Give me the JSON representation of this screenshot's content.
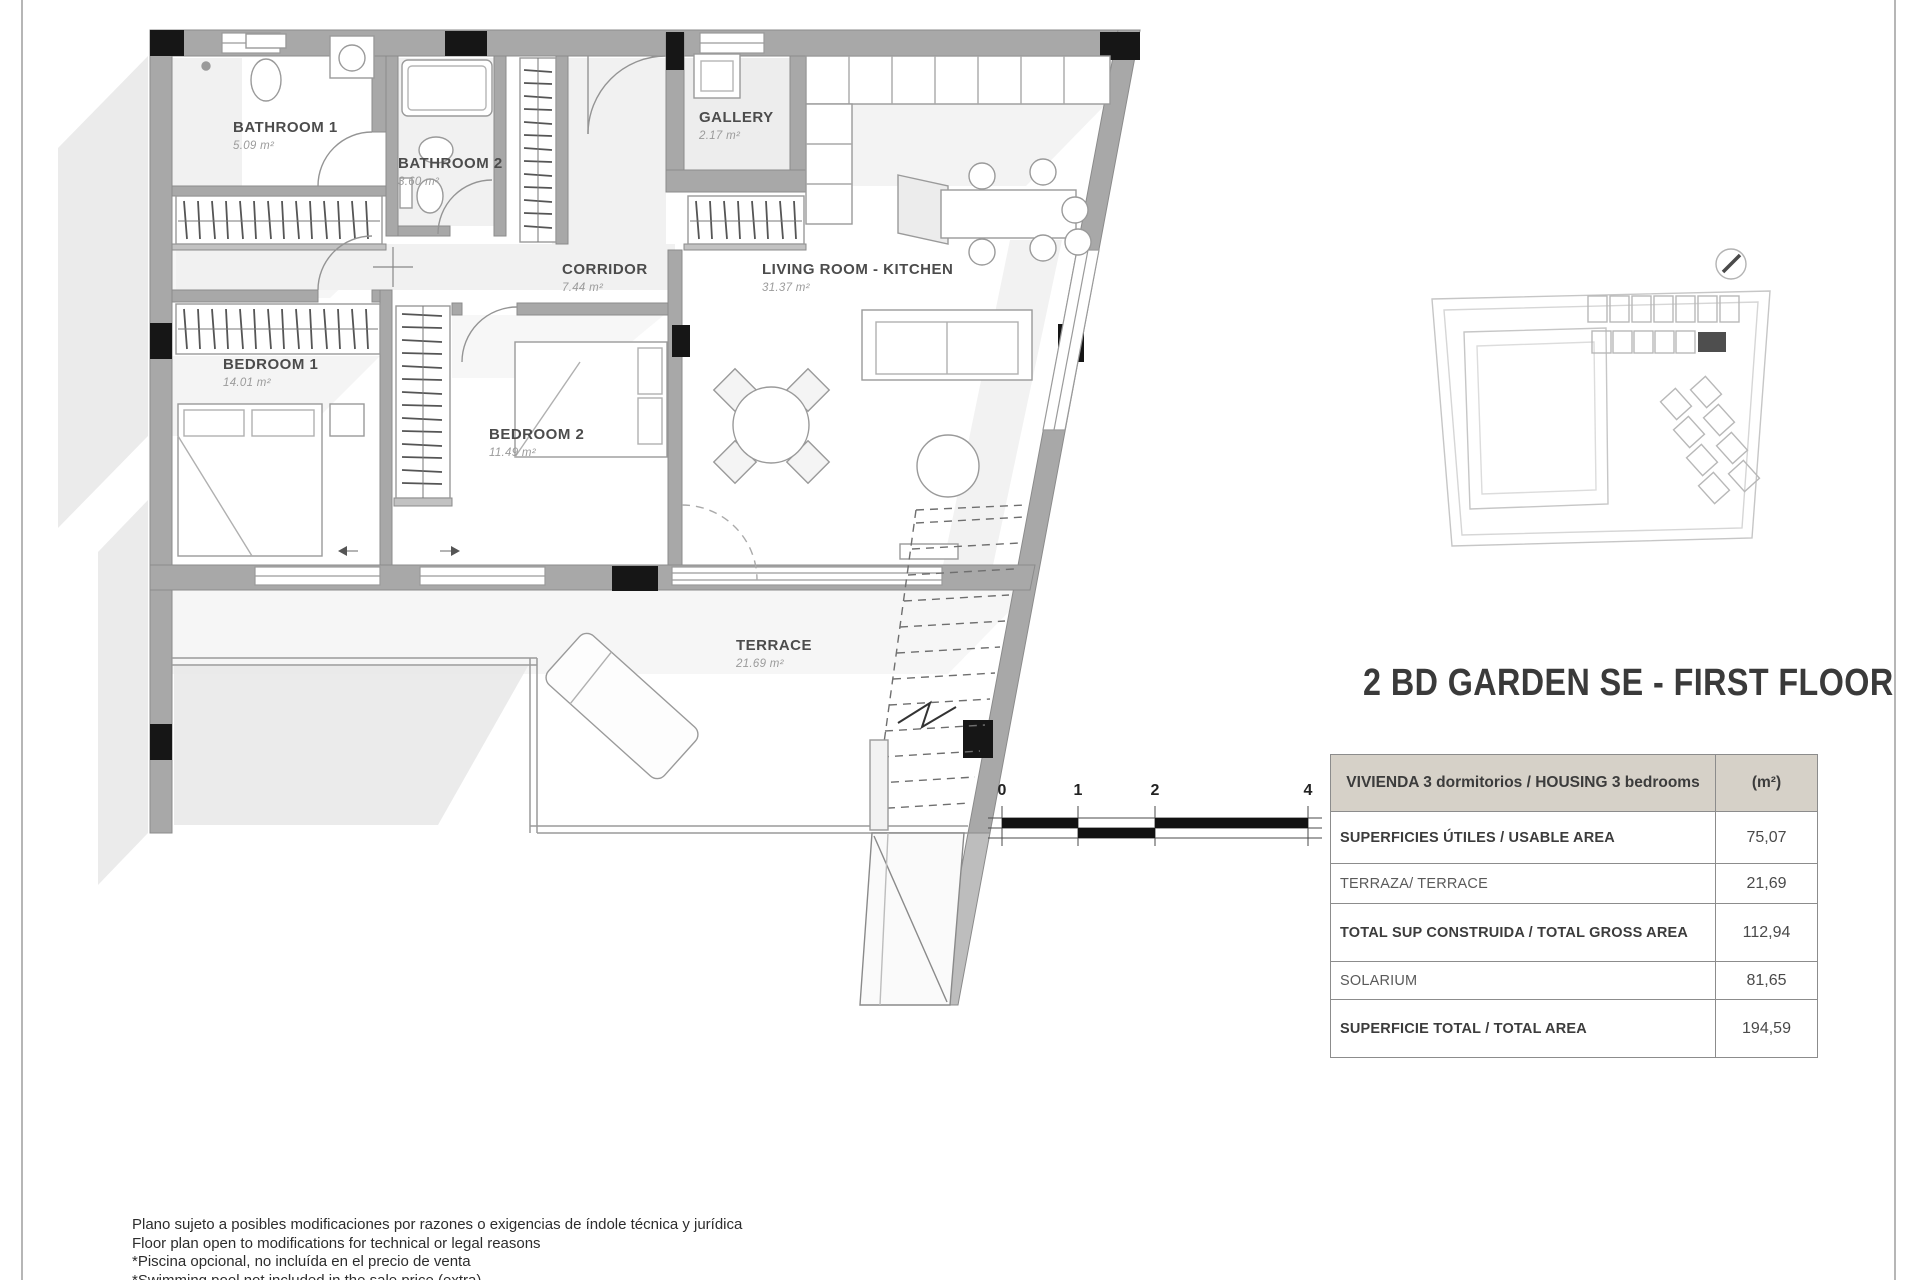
{
  "page": {
    "title": "2 BD GARDEN SE - FIRST FLOOR"
  },
  "plan": {
    "rooms": [
      {
        "name": "BATHROOM 1",
        "area": "5.09 m²"
      },
      {
        "name": "BATHROOM 2",
        "area": "3.60 m²"
      },
      {
        "name": "GALLERY",
        "area": "2.17 m²"
      },
      {
        "name": "CORRIDOR",
        "area": "7.44 m²"
      },
      {
        "name": "LIVING ROOM - KITCHEN",
        "area": "31.37 m²"
      },
      {
        "name": "BEDROOM 1",
        "area": "14.01 m²"
      },
      {
        "name": "BEDROOM 2",
        "area": "11.49 m²"
      },
      {
        "name": "TERRACE",
        "area": "21.69 m²"
      }
    ],
    "scale_bar": {
      "labels": [
        "0",
        "1",
        "2",
        "4"
      ]
    }
  },
  "summary_table": {
    "header": {
      "label": "VIVIENDA 3 dormitorios / HOUSING 3 bedrooms",
      "unit": "(m²)"
    },
    "rows": [
      {
        "label": "SUPERFICIES ÚTILES / USABLE AREA",
        "value": "75,07"
      },
      {
        "label": "TERRAZA/ TERRACE",
        "value": "21,69"
      },
      {
        "label": "TOTAL SUP CONSTRUIDA / TOTAL GROSS AREA",
        "value": "112,94"
      },
      {
        "label": "SOLARIUM",
        "value": "81,65"
      },
      {
        "label": "SUPERFICIE TOTAL / TOTAL AREA",
        "value": "194,59"
      }
    ]
  },
  "footnotes": {
    "lines": [
      "Plano sujeto a posibles modificaciones por razones o exigencias de índole técnica y jurídica",
      "Floor plan open to modifications for technical or legal reasons",
      "*Piscina opcional, no incluída en el precio de venta",
      "*Swimming pool not included in the sale price (extra)"
    ]
  },
  "colors": {
    "wall_gray": "#a8a8a8",
    "column_black": "#161616",
    "table_header_bg": "#d6d1c8",
    "highlighted_unit": "#4e4e4e"
  }
}
